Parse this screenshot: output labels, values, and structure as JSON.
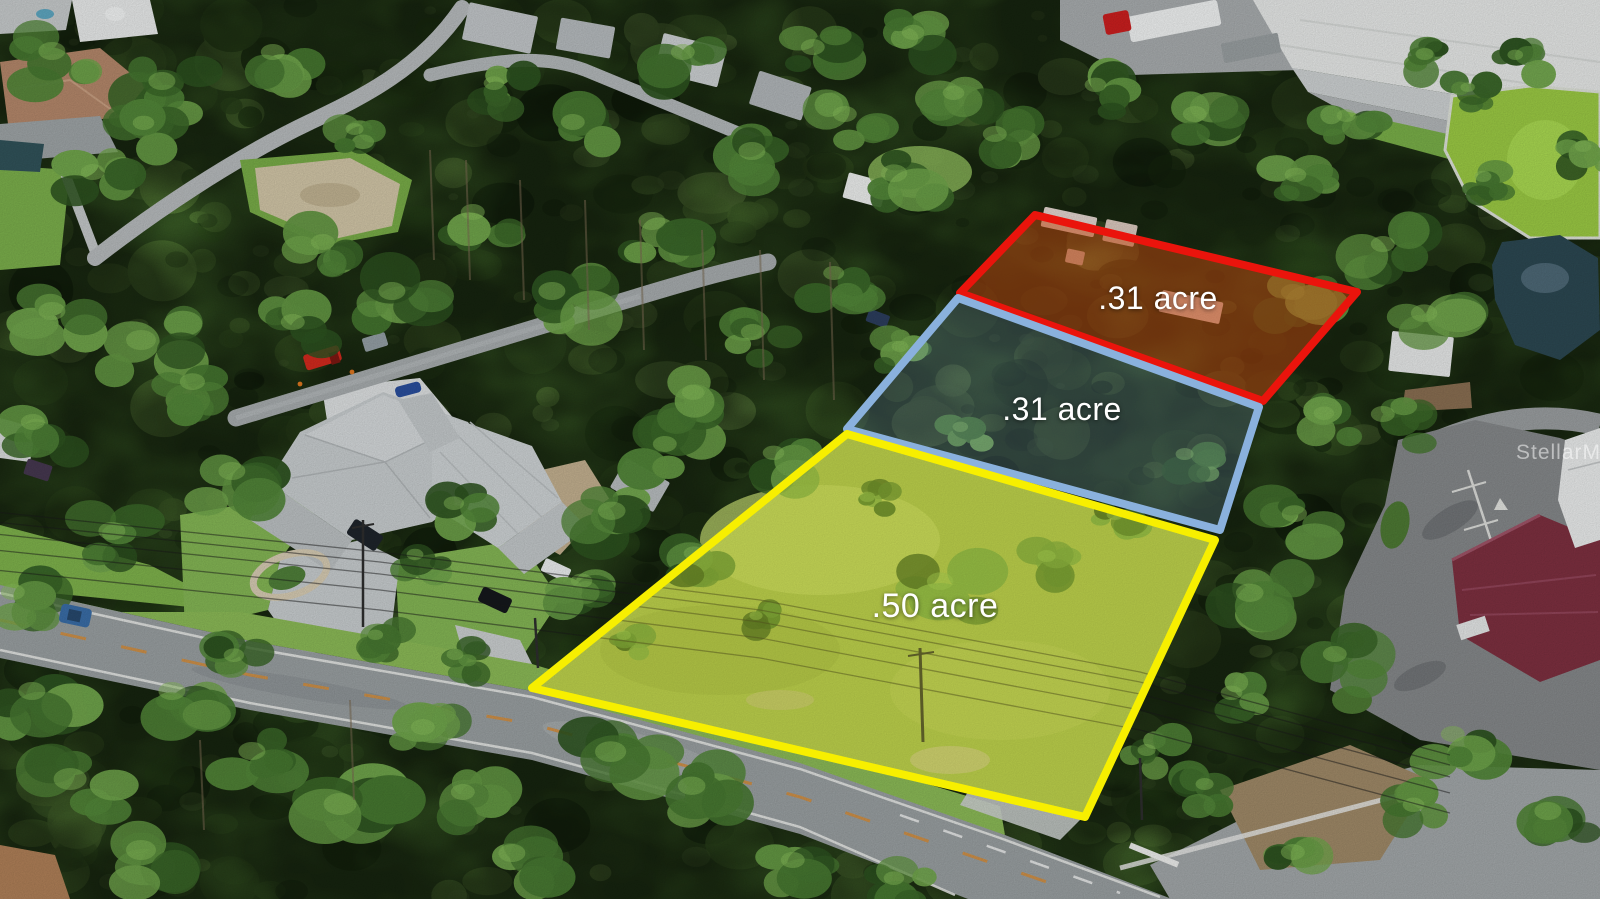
{
  "meta": {
    "description": "Aerial drone photo of three adjoining land parcels outlined for sale along a two-lane road",
    "watermark": "StellarMLS"
  },
  "parcels": {
    "rear": {
      "label": ".31 acre",
      "outline_color": "#ea140c",
      "fill_color": "rgba(196,70,14,0.50)"
    },
    "middle": {
      "label": ".31 acre",
      "outline_color": "#8ab1dd",
      "fill_color": "rgba(130,168,215,0.22)"
    },
    "front": {
      "label": ".50 acre",
      "outline_color": "#f7ef00",
      "fill_color": "rgba(238,242,45,0.26)"
    }
  }
}
